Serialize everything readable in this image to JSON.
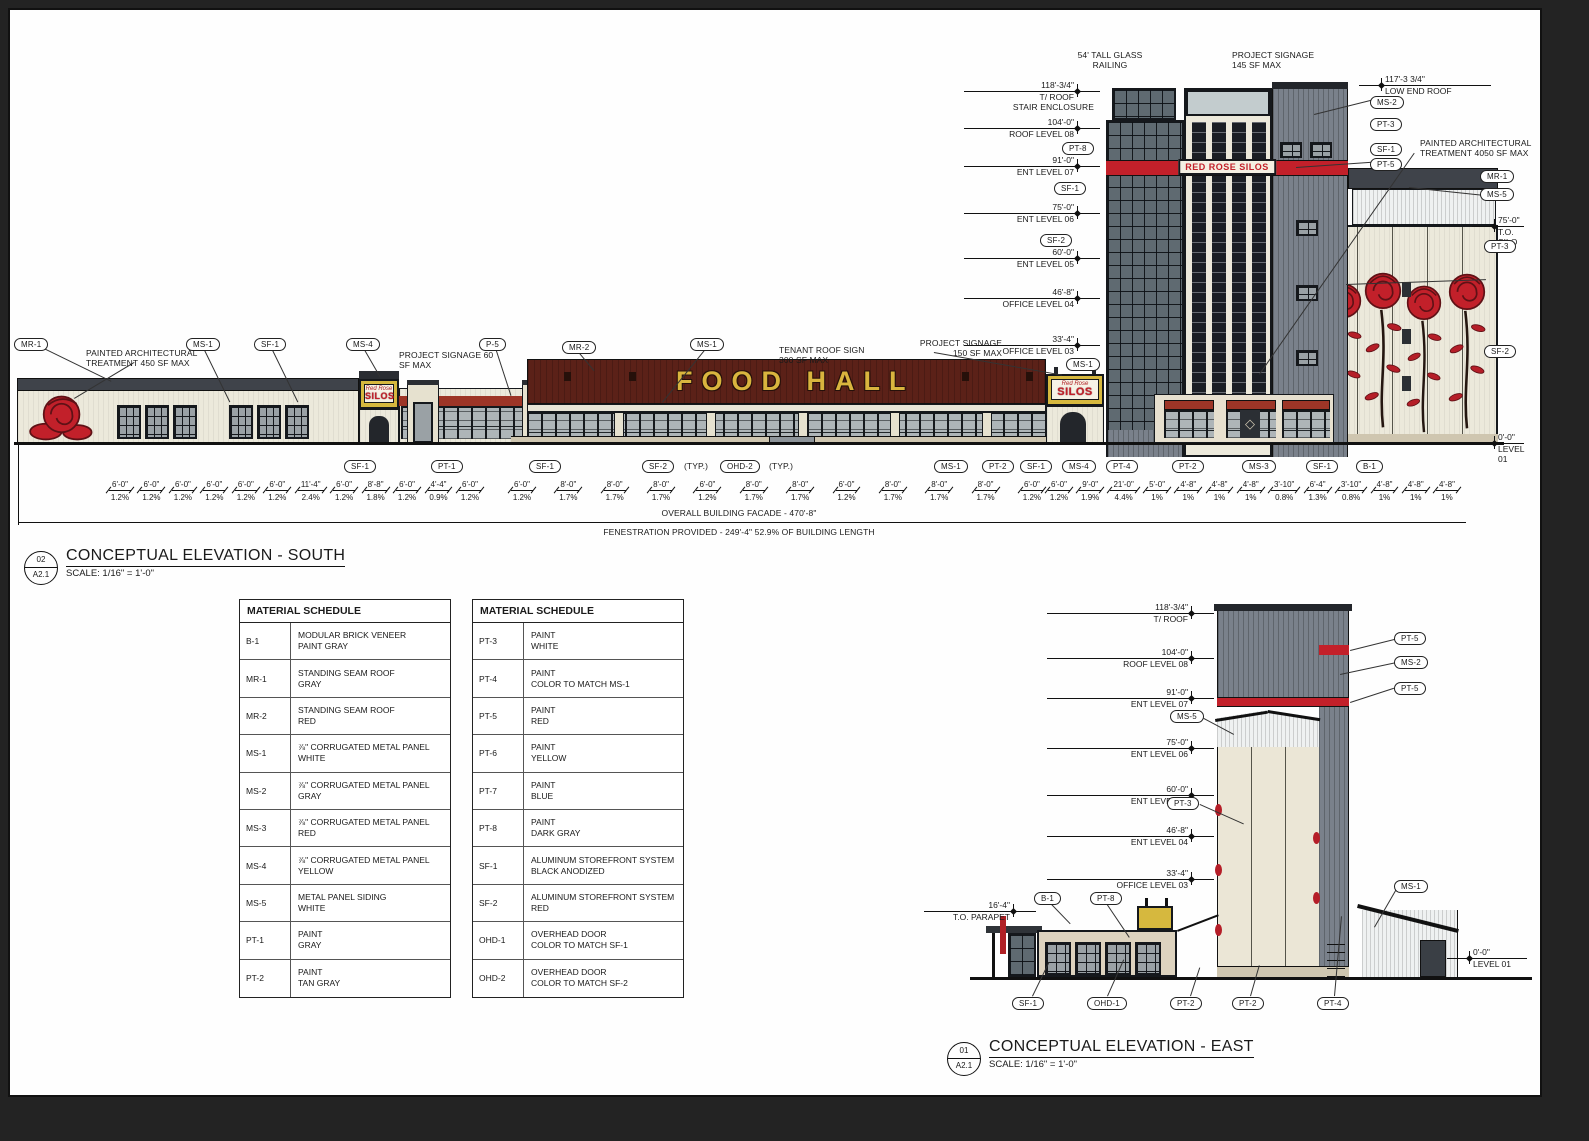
{
  "palette": {
    "sheet_bg": "#fefefe",
    "line": "#111111",
    "cream_wall": "#ece9db",
    "maroon_roof": "#5b2118",
    "bright_red": "#c3202a",
    "brick_red": "#9d3527",
    "sign_yellow": "#d6b83e",
    "gray_panel": "#7a818b",
    "dark_roof": "#3f434a",
    "glass": "#5f6a71",
    "tan_base": "#cfc6b0"
  },
  "south": {
    "tags_top": [
      "MR-1",
      "MS-1",
      "SF-1",
      "MS-4",
      "P-5",
      "MR-2",
      "MS-1",
      "MS-1"
    ],
    "tags_tower_left": [
      "PT-8",
      "SF-1",
      "SF-2"
    ],
    "tags_tower_right": [
      "MS-2",
      "PT-3",
      "SF-1",
      "PT-5"
    ],
    "tags_far_right": [
      "MR-1",
      "MS-5",
      "PT-3",
      "SF-2"
    ],
    "tags_bottom": [
      "SF-1",
      "PT-1",
      "SF-1",
      "SF-2",
      "OHD-2",
      "MS-1",
      "PT-2",
      "SF-1",
      "MS-4",
      "PT-4",
      "PT-2",
      "MS-3",
      "SF-1",
      "B-1"
    ],
    "typ_note": "(TYP.)",
    "levels_left": [
      {
        "v": "118'-3/4\"",
        "l": "T/ ROOF"
      },
      {
        "v": "104'-0\"",
        "l": "ROOF LEVEL 08"
      },
      {
        "v": "91'-0\"",
        "l": "ENT LEVEL 07"
      },
      {
        "v": "75'-0\"",
        "l": "ENT LEVEL 06"
      },
      {
        "v": "60'-0\"",
        "l": "ENT LEVEL 05"
      },
      {
        "v": "46'-8\"",
        "l": "OFFICE LEVEL 04"
      },
      {
        "v": "33'-4\"",
        "l": "OFFICE LEVEL 03"
      }
    ],
    "levels_right": [
      {
        "v": "117'-3 3/4\"",
        "l": "LOW END ROOF"
      },
      {
        "v": "75'-0\"",
        "l": "T.O. SILO"
      },
      {
        "v": "0'-0\"",
        "l": "LEVEL 01"
      }
    ],
    "notes": {
      "glass_railing": "54' TALL GLASS\nRAILING",
      "project_signage_145": "PROJECT SIGNAGE\n145 SF MAX",
      "stair_enclosure": "STAIR ENCLOSURE",
      "painted_4050": "PAINTED ARCHITECTURAL\nTREATMENT 4050 SF MAX",
      "painted_450": "PAINTED ARCHITECTURAL\nTREATMENT 450 SF MAX",
      "project_signage_60": "PROJECT SIGNAGE 60\nSF MAX",
      "tenant_roof_sign": "TENANT ROOF SIGN\n300 SF MAX",
      "project_signage_150": "PROJECT SIGNAGE\n150 SF MAX"
    },
    "signs": {
      "food_hall": "FOOD HALL",
      "band": "RED ROSE SILOS",
      "small_script": "Red Rose",
      "small_main": "SILOS"
    },
    "dims_a": [
      {
        "d": "6'-0\"",
        "p": "1.2%"
      },
      {
        "d": "6'-0\"",
        "p": "1.2%"
      },
      {
        "d": "6'-0\"",
        "p": "1.2%"
      },
      {
        "d": "6'-0\"",
        "p": "1.2%"
      },
      {
        "d": "6'-0\"",
        "p": "1.2%"
      },
      {
        "d": "6'-0\"",
        "p": "1.2%"
      },
      {
        "d": "11'-4\"",
        "p": "2.4%"
      },
      {
        "d": "6'-0\"",
        "p": "1.2%"
      },
      {
        "d": "8'-8\"",
        "p": "1.8%"
      },
      {
        "d": "6'-0\"",
        "p": "1.2%"
      },
      {
        "d": "4'-4\"",
        "p": "0.9%"
      },
      {
        "d": "6'-0\"",
        "p": "1.2%"
      }
    ],
    "dims_b": [
      {
        "d": "6'-0\"",
        "p": "1.2%"
      },
      {
        "d": "8'-0\"",
        "p": "1.7%"
      },
      {
        "d": "8'-0\"",
        "p": "1.7%"
      },
      {
        "d": "8'-0\"",
        "p": "1.7%"
      },
      {
        "d": "6'-0\"",
        "p": "1.2%"
      },
      {
        "d": "8'-0\"",
        "p": "1.7%"
      },
      {
        "d": "8'-0\"",
        "p": "1.7%"
      },
      {
        "d": "6'-0\"",
        "p": "1.2%"
      },
      {
        "d": "8'-0\"",
        "p": "1.7%"
      },
      {
        "d": "8'-0\"",
        "p": "1.7%"
      },
      {
        "d": "8'-0\"",
        "p": "1.7%"
      },
      {
        "d": "6'-0\"",
        "p": "1.2%"
      }
    ],
    "dims_c": [
      {
        "d": "6'-0\"",
        "p": "1.2%"
      },
      {
        "d": "9'-0\"",
        "p": "1.9%"
      },
      {
        "d": "21'-0\"",
        "p": "4.4%"
      },
      {
        "d": "5'-0\"",
        "p": "1%"
      },
      {
        "d": "4'-8\"",
        "p": "1%"
      },
      {
        "d": "4'-8\"",
        "p": "1%"
      },
      {
        "d": "4'-8\"",
        "p": "1%"
      },
      {
        "d": "3'-10\"",
        "p": "0.8%"
      },
      {
        "d": "6'-4\"",
        "p": "1.3%"
      },
      {
        "d": "3'-10\"",
        "p": "0.8%"
      },
      {
        "d": "4'-8\"",
        "p": "1%"
      },
      {
        "d": "4'-8\"",
        "p": "1%"
      },
      {
        "d": "4'-8\"",
        "p": "1%"
      }
    ],
    "facade_note": "OVERALL BUILDING FACADE - 470'-8\"",
    "fenestration_note": "FENESTRATION PROVIDED - 249'-4\" 52.9% OF BUILDING LENGTH",
    "title_block": {
      "no": "02",
      "sheet": "A2.1",
      "title": "CONCEPTUAL ELEVATION - SOUTH",
      "scale": "SCALE: 1/16\" = 1'-0\""
    }
  },
  "schedules": [
    {
      "title": "MATERIAL SCHEDULE",
      "rows": [
        {
          "code": "B-1",
          "desc": "MODULAR BRICK VENEER\nPAINT GRAY"
        },
        {
          "code": "MR-1",
          "desc": "STANDING SEAM ROOF\nGRAY"
        },
        {
          "code": "MR-2",
          "desc": "STANDING SEAM ROOF\nRED"
        },
        {
          "code": "MS-1",
          "desc": "⅞\" CORRUGATED METAL PANEL\nWHITE"
        },
        {
          "code": "MS-2",
          "desc": "⅞\" CORRUGATED METAL PANEL\nGRAY"
        },
        {
          "code": "MS-3",
          "desc": "⅞\" CORRUGATED METAL PANEL\nRED"
        },
        {
          "code": "MS-4",
          "desc": "⅞\" CORRUGATED METAL PANEL\nYELLOW"
        },
        {
          "code": "MS-5",
          "desc": "METAL PANEL SIDING\nWHITE"
        },
        {
          "code": "PT-1",
          "desc": "PAINT\nGRAY"
        },
        {
          "code": "PT-2",
          "desc": "PAINT\nTAN GRAY"
        }
      ]
    },
    {
      "title": "MATERIAL SCHEDULE",
      "rows": [
        {
          "code": "PT-3",
          "desc": "PAINT\nWHITE"
        },
        {
          "code": "PT-4",
          "desc": "PAINT\nCOLOR TO MATCH MS-1"
        },
        {
          "code": "PT-5",
          "desc": "PAINT\nRED"
        },
        {
          "code": "PT-6",
          "desc": "PAINT\nYELLOW"
        },
        {
          "code": "PT-7",
          "desc": "PAINT\nBLUE"
        },
        {
          "code": "PT-8",
          "desc": "PAINT\nDARK GRAY"
        },
        {
          "code": "SF-1",
          "desc": "ALUMINUM STOREFRONT SYSTEM\nBLACK ANODIZED"
        },
        {
          "code": "SF-2",
          "desc": "ALUMINUM STOREFRONT SYSTEM\nRED"
        },
        {
          "code": "OHD-1",
          "desc": "OVERHEAD DOOR\nCOLOR TO MATCH SF-1"
        },
        {
          "code": "OHD-2",
          "desc": "OVERHEAD DOOR\nCOLOR TO MATCH SF-2"
        }
      ]
    }
  ],
  "east": {
    "levels_left": [
      {
        "v": "118'-3/4\"",
        "l": "T/ ROOF"
      },
      {
        "v": "104'-0\"",
        "l": "ROOF LEVEL 08"
      },
      {
        "v": "91'-0\"",
        "l": "ENT LEVEL 07"
      },
      {
        "v": "75'-0\"",
        "l": "ENT LEVEL 06"
      },
      {
        "v": "60'-0\"",
        "l": "ENT LEVEL 05"
      },
      {
        "v": "46'-8\"",
        "l": "ENT LEVEL 04"
      },
      {
        "v": "33'-4\"",
        "l": "OFFICE LEVEL 03"
      }
    ],
    "parapet": {
      "v": "16'-4\"",
      "l": "T.O. PARAPET"
    },
    "level01": {
      "v": "0'-0\"",
      "l": "LEVEL 01"
    },
    "tags_right": [
      "PT-5",
      "MS-2",
      "PT-5"
    ],
    "tag_ms5": "MS-5",
    "tag_pt3": "PT-3",
    "tag_ms1": "MS-1",
    "tag_b1": "B-1",
    "tag_pt8": "PT-8",
    "tags_bottom": [
      "SF-1",
      "OHD-1",
      "PT-2",
      "PT-2",
      "PT-4"
    ],
    "title_block": {
      "no": "01",
      "sheet": "A2.1",
      "title": "CONCEPTUAL ELEVATION - EAST",
      "scale": "SCALE: 1/16\" = 1'-0\""
    }
  }
}
